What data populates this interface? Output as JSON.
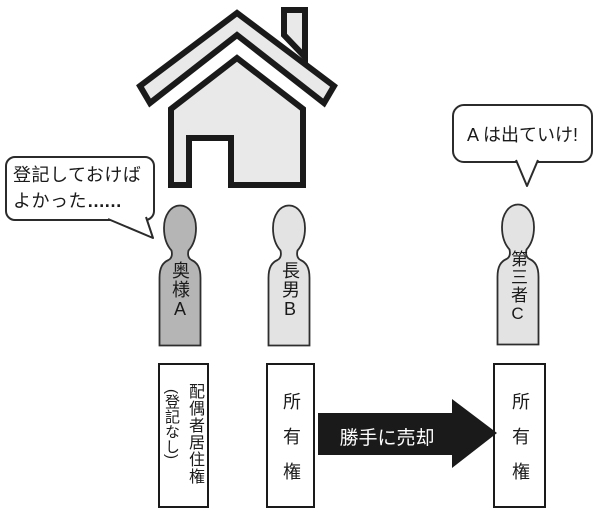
{
  "colors": {
    "house_fill": "#e9e9e9",
    "wife_fill": "#b5b5b5",
    "person_fill": "#e3e3e3",
    "arrow_fill": "#1a1a1a",
    "outline": "#1a1a1a"
  },
  "bubbles": {
    "wife": {
      "line1": "登記しておけば",
      "line2": "よかった",
      "ellipsis": "……"
    },
    "third_party": {
      "text": "A は出ていけ!"
    }
  },
  "figures": {
    "wife": {
      "label": "奥様A"
    },
    "eldest_son": {
      "label": "長男B"
    },
    "third_party": {
      "label": "第三者C"
    }
  },
  "right_boxes": {
    "wife": {
      "line1": "配偶者居住権",
      "line2": "(登記なし)"
    },
    "eldest_son": {
      "label": "所有権"
    },
    "third_party": {
      "label": "所有権"
    }
  },
  "arrow": {
    "label": "勝手に売却"
  }
}
